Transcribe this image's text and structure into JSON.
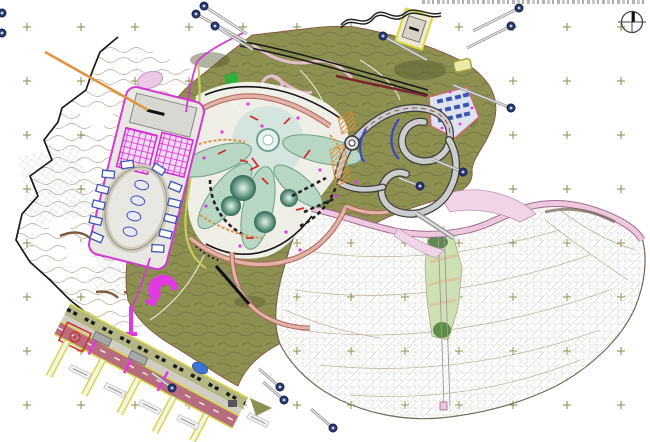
{
  "meta": {
    "type": "cad-master-plan",
    "canvas_width": 650,
    "canvas_height": 442,
    "background": "#ffffff"
  },
  "header": {
    "clipped_title_visible": true,
    "clipped_title_legible": false
  },
  "north_arrow": {
    "icon": "north-arrow-icon"
  },
  "survey_grid": {
    "spacing_px": 54,
    "marker": "plus-cross"
  },
  "counts": {
    "callout_badges": 15,
    "leader_lines": 13,
    "piers": 5,
    "pier_labels": 5,
    "resort_petals": 5,
    "resort_cones": 4,
    "cottage_lots": 12,
    "village_buildings": 12,
    "court_blocks": 2,
    "magenta_crosswalks": 3
  },
  "palette": {
    "survey_cross": "#8a8a42",
    "terrain_contour": "#a8927a",
    "terrain_boundary": "#1a1a1a",
    "terrain_squiggle": "#7d5a3a",
    "green_base": "#8e9052",
    "green_texture": "#6c6e3c",
    "white_resort": "#f4f3ef",
    "lake_dot": "#8f8875",
    "lake_line": "#c3bdae",
    "lake_boundary": "#6e6655",
    "pink_road_fill": "#ecc9de",
    "pink_road_edge": "#a06b92",
    "ski_green_light": "#cfe0b4",
    "ski_green_dark": "#4a7a3a",
    "salmon_road": "#e0b3a8",
    "salmon_edge": "#b3655a",
    "road_gray": "#cccccc",
    "road_edge": "#3f3f3f",
    "magenta": "#cf3ccf",
    "magenta_bright": "#e23ae2",
    "court_pink": "#f3d9f3",
    "promenade_mauve": "#b76d7e",
    "promenade_yellow": "#d6d648",
    "beach_band": "#b5b586",
    "badge_navy": "#2c3b72",
    "lance_gray": "#8f8f8f",
    "blue_building": "#3b55b5",
    "blue_line": "#3946c8",
    "orange": "#e0923c",
    "red": "#cf2f2f",
    "petal_teal": "#b7d6c3",
    "petal_edge": "#6f9f87",
    "plaza_teal": "#cfe3da",
    "cone_light": "#cfe8da",
    "cone_dark": "#2e6b52",
    "highway_black": "#1c1c1c",
    "maroon": "#7a2430",
    "parcel_yellow": "#d9d93e",
    "pond_blue": "#3f74cf",
    "pink_blob": "#ecc9e6",
    "olive_road": "#c9c95e",
    "gray_building": "#d9d7d2",
    "north_arrow_color": "#444444"
  },
  "features": [
    {
      "id": "existing-terrain-west",
      "kind": "terrain"
    },
    {
      "id": "landscaped-green-terrain",
      "kind": "terrain"
    },
    {
      "id": "hatched-slope-basin",
      "kind": "terrain"
    },
    {
      "id": "resort-petal-complex",
      "kind": "development"
    },
    {
      "id": "cottage-parcel",
      "kind": "development"
    },
    {
      "id": "hillside-village",
      "kind": "development"
    },
    {
      "id": "serpentine-loop-road",
      "kind": "road"
    },
    {
      "id": "upper-highway",
      "kind": "road"
    },
    {
      "id": "lakeside-pink-road",
      "kind": "road"
    },
    {
      "id": "waterfront-promenade",
      "kind": "road"
    },
    {
      "id": "piers",
      "kind": "marine"
    },
    {
      "id": "ski-run-strip",
      "kind": "recreation"
    },
    {
      "id": "funicular-line",
      "kind": "transport"
    },
    {
      "id": "callout-badges",
      "kind": "annotation"
    },
    {
      "id": "north-arrow",
      "kind": "annotation"
    }
  ]
}
